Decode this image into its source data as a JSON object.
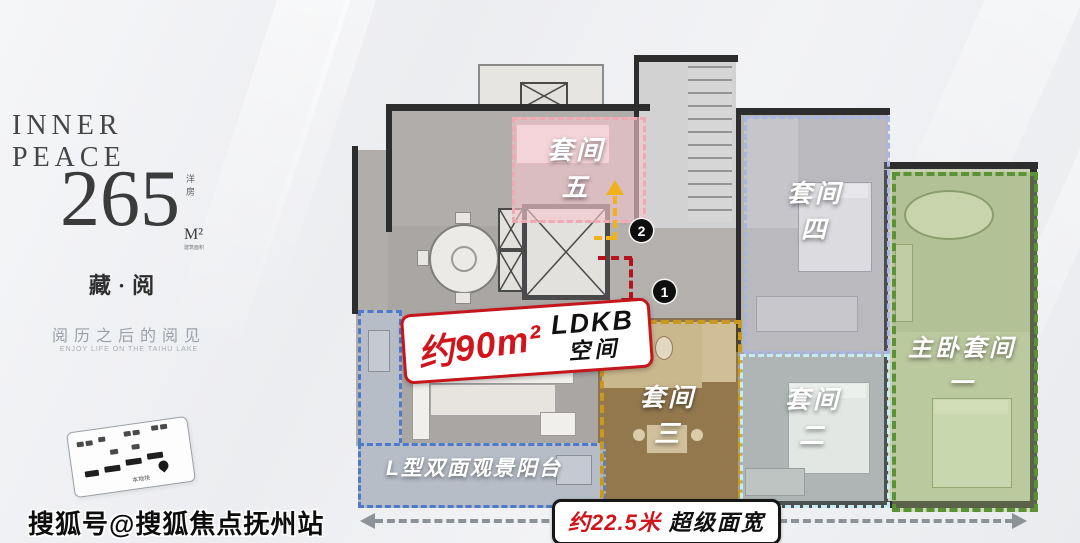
{
  "branding": {
    "logo": "INNER PEACE",
    "area_value": "265",
    "area_unit": "M²",
    "area_type_vertical": "洋房",
    "area_note": "建筑面积",
    "product_name": "藏·阅",
    "tagline_cn": "阅历之后的阅见",
    "tagline_en": "ENJOY LIFE ON THE TAIHU LAKE",
    "site_card_note": "本地块"
  },
  "watermark": "搜狐号@搜狐焦点抚州站",
  "plan": {
    "suite5_line1": "套间",
    "suite5_line2": "五",
    "suite4_line1": "套间",
    "suite4_line2": "四",
    "master_line1": "主卧套间",
    "master_line2": "一",
    "suite3_line1": "套间",
    "suite3_line2": "三",
    "suite2_line1": "套间",
    "suite2_line2": "二",
    "balcony_label": "L型双面观景阳台",
    "ldk_area": "约90m²",
    "ldk_line1": "LDKB",
    "ldk_line2": "空间",
    "marker_1": "1",
    "marker_2": "2",
    "width_value": "约22.5米",
    "width_label": "超级面宽"
  },
  "colors": {
    "suite5_border": "#F0A8B2",
    "suite4_border": "#A9B6E3",
    "master_border": "#5C9135",
    "suite3_border": "#C7991E",
    "suite2_border": "#C6EBF0",
    "balcony_border": "#4F79C9",
    "ldk_accent": "#C4161C",
    "arrow_yellow": "#F1B11C",
    "arrow_red": "#B5121B",
    "dimension_red": "#D0161C"
  }
}
